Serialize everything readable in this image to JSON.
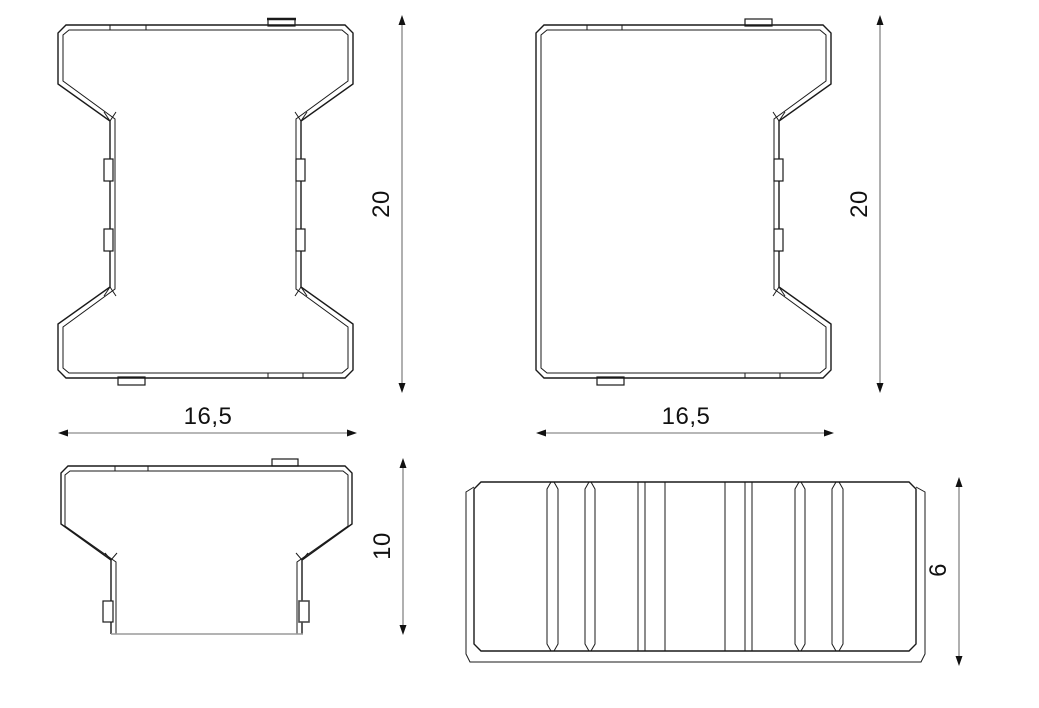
{
  "drawing": {
    "type": "technical-orthographic-views",
    "subject": "H-shaped interlocking paver block",
    "background_color": "#ffffff",
    "line_color": "#1a1a1a",
    "dim_line_color": "#6f6f6f",
    "dimensions": {
      "plan_full_height": "20",
      "plan_full_width": "16,5",
      "plan_half_height": "20",
      "plan_half_width": "16,5",
      "front_height": "10",
      "side_height": "6"
    }
  }
}
